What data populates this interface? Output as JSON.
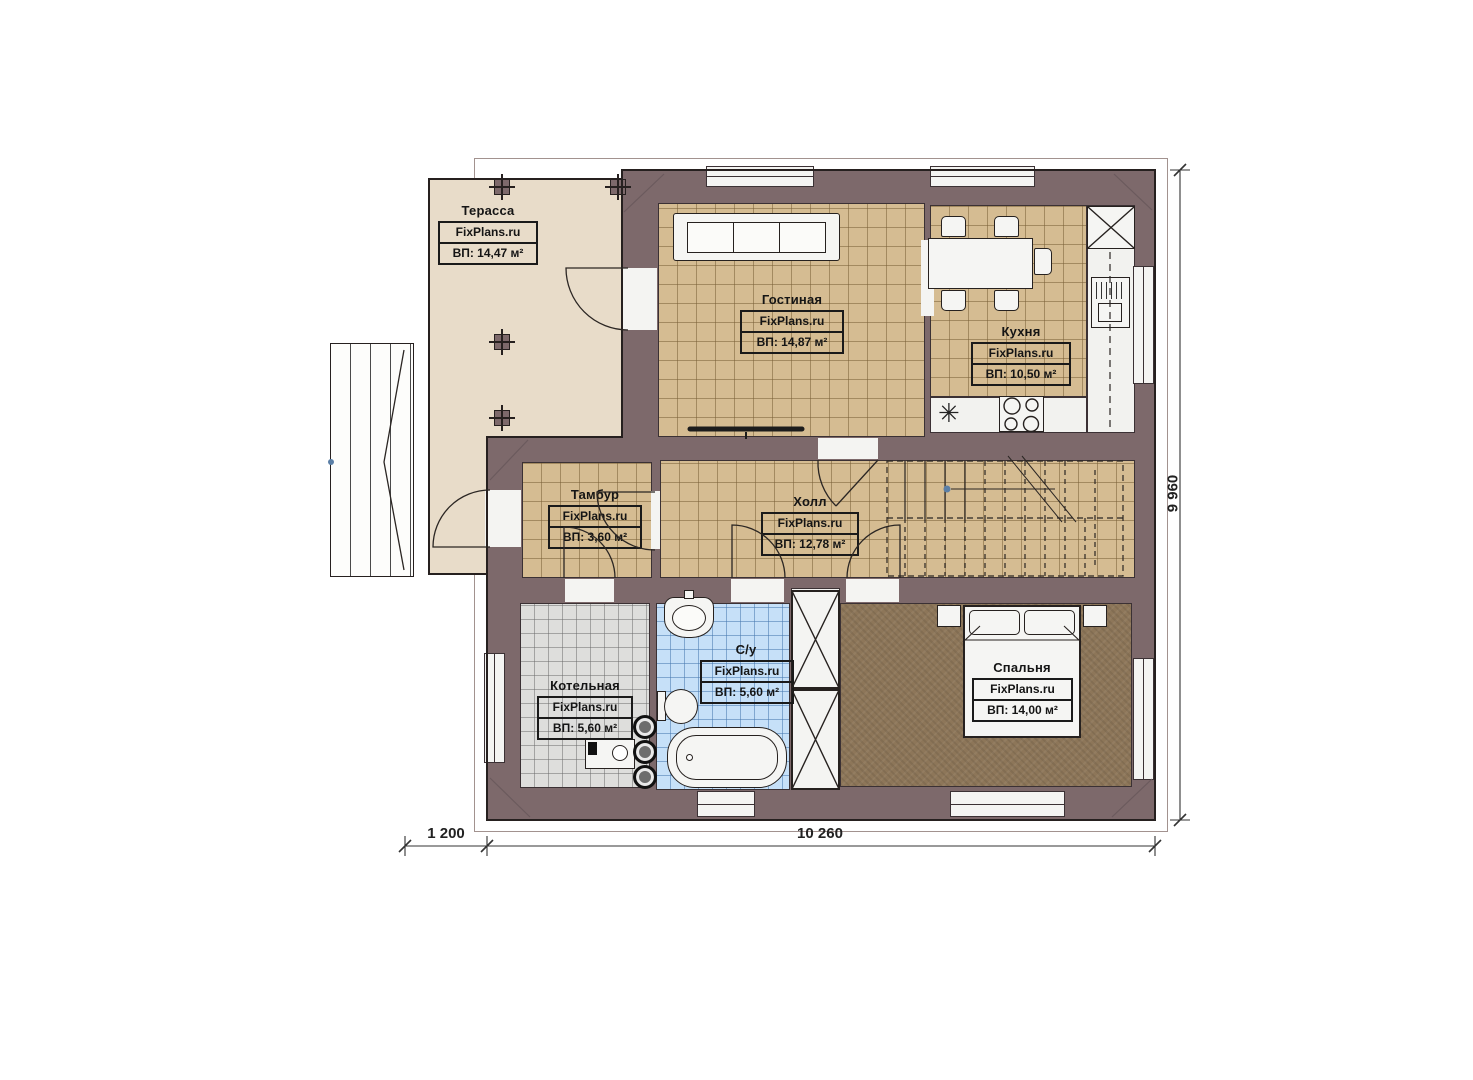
{
  "plan": {
    "title": "План первого этажа",
    "brand": "FixPlans.ru",
    "rooms": [
      {
        "key": "terrace",
        "name": "Терасса",
        "brand": "FixPlans.ru",
        "area": "ВП: 14,47 м²"
      },
      {
        "key": "living",
        "name": "Гостиная",
        "brand": "FixPlans.ru",
        "area": "ВП: 14,87 м²"
      },
      {
        "key": "kitchen",
        "name": "Кухня",
        "brand": "FixPlans.ru",
        "area": "ВП: 10,50 м²"
      },
      {
        "key": "tambour",
        "name": "Тамбур",
        "brand": "FixPlans.ru",
        "area": "ВП: 3,60 м²"
      },
      {
        "key": "hall",
        "name": "Холл",
        "brand": "FixPlans.ru",
        "area": "ВП: 12,78 м²"
      },
      {
        "key": "boiler",
        "name": "Котельная",
        "brand": "FixPlans.ru",
        "area": "ВП: 5,60 м²"
      },
      {
        "key": "bathroom",
        "name": "С/у",
        "brand": "FixPlans.ru",
        "area": "ВП: 5,60 м²"
      },
      {
        "key": "bedroom",
        "name": "Спальня",
        "brand": "FixPlans.ru",
        "area": "ВП: 14,00 м²"
      }
    ],
    "dimensions": {
      "bottom_left": "1 200",
      "bottom_main": "10 260",
      "right_side": "9 960"
    },
    "icons": {
      "kitchen_sink": "✳"
    },
    "colors": {
      "wall": "#7d696b",
      "terrace_floor": "#e8dcc9",
      "wood_floor": "#d5bc92",
      "gray_tile": "#dededc",
      "blue_tile": "#c6e0f8",
      "carpet": "#8d7659",
      "fixture_white": "#f5f5f3",
      "outline": "#2e2629"
    }
  }
}
